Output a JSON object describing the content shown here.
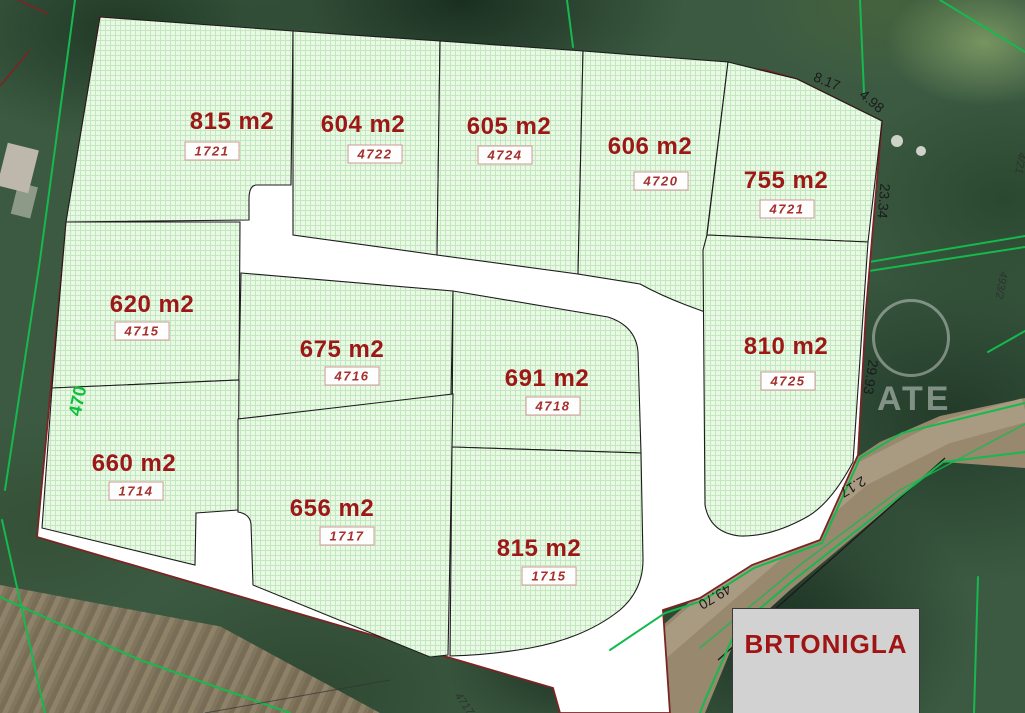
{
  "place": {
    "label": "BRTONIGLA"
  },
  "parcels": [
    {
      "id": "top-1",
      "area": "815 m2",
      "number": "1721"
    },
    {
      "id": "top-2",
      "area": "604 m2",
      "number": "4722"
    },
    {
      "id": "top-3",
      "area": "605 m2",
      "number": "4724"
    },
    {
      "id": "top-4",
      "area": "606 m2",
      "number": "4720"
    },
    {
      "id": "top-5",
      "area": "755 m2",
      "number": "4721"
    },
    {
      "id": "mid-left",
      "area": "620 m2",
      "number": "4715"
    },
    {
      "id": "mid-1",
      "area": "675 m2",
      "number": "4716"
    },
    {
      "id": "mid-2",
      "area": "691 m2",
      "number": "4718"
    },
    {
      "id": "mid-right",
      "area": "810 m2",
      "number": "4725"
    },
    {
      "id": "bot-1",
      "area": "660 m2",
      "number": "1714"
    },
    {
      "id": "bot-2",
      "area": "656 m2",
      "number": "1717"
    },
    {
      "id": "bot-3",
      "area": "815 m2",
      "number": "1715"
    }
  ],
  "measurements": [
    {
      "id": "edge-top-right-1",
      "value": "8.17"
    },
    {
      "id": "edge-top-right-2",
      "value": "4.98"
    },
    {
      "id": "edge-right-upper",
      "value": "23.34"
    },
    {
      "id": "edge-right-lower",
      "value": "29.93"
    },
    {
      "id": "edge-road-upper",
      "value": "2.17"
    },
    {
      "id": "edge-road-lower",
      "value": "49.70"
    }
  ],
  "road_number": "470",
  "neighbor_numbers": [
    {
      "value": "4/21"
    },
    {
      "value": "493/2"
    },
    {
      "value": "4717"
    }
  ],
  "watermark": {
    "text": "ATE"
  },
  "colors": {
    "area_text": "#9e1717",
    "parcel_number_text": "#a32020",
    "boundary_red": "#7b2424",
    "cadastral_green": "#16b94e",
    "parcel_fill": "#eaf8e7",
    "place_text": "#a11414"
  }
}
